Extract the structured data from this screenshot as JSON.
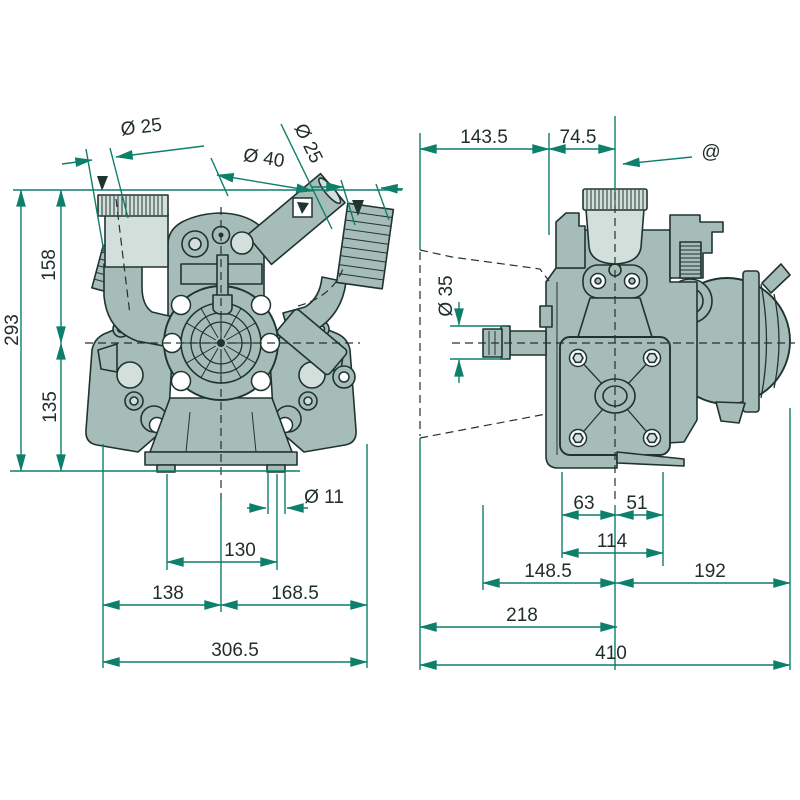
{
  "colors": {
    "body": "#a6bcb8",
    "light": "#d3dfda",
    "ink": "#20342f",
    "dim": "#0d7f6a",
    "txt": "#1e2d2a",
    "bg": "#ffffff"
  },
  "front_view": {
    "dims": {
      "port_left_dia": "Ø 25",
      "port_center_dia": "Ø 40",
      "port_right_dia": "Ø 25",
      "height_total": "293",
      "height_upper": "158",
      "height_lower": "135",
      "slot_dia": "Ø 11",
      "slot_spacing": "130",
      "width_left_of_center": "138",
      "width_right_of_center": "168.5",
      "width_total": "306.5"
    }
  },
  "side_view": {
    "dims": {
      "offset_left": "143.5",
      "offset_center": "74.5",
      "marker_at": "@",
      "shaft_dia": "Ø 35",
      "foot_left": "63",
      "foot_right": "51",
      "foot_span": "114",
      "span_front": "148.5",
      "span_rear": "192",
      "span_left": "218",
      "width_total": "410"
    }
  }
}
